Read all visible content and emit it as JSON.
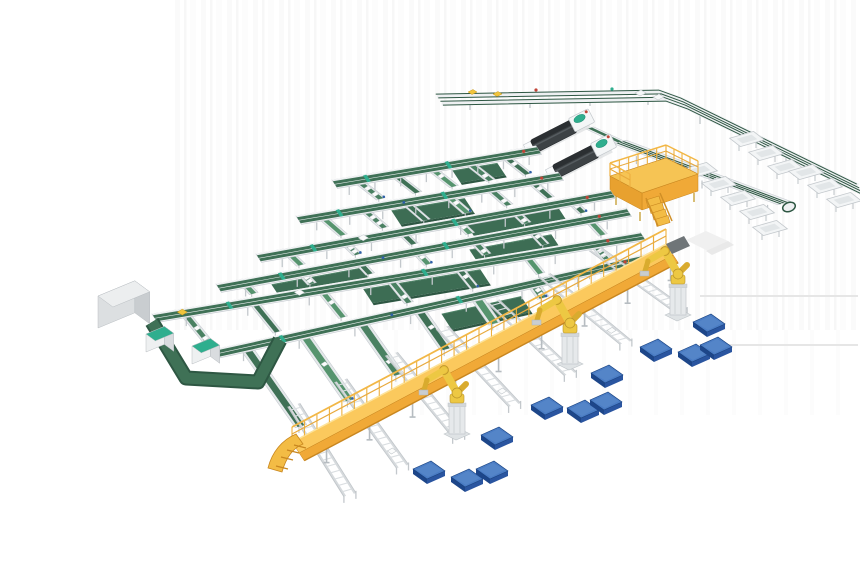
{
  "image": {
    "kind": "3d-isometric-render",
    "alt": "Isometric 3D render of an automated parcel sorting and palletizing system on a white background",
    "background": "white"
  },
  "equipment": {
    "trunk_conveyors": {
      "label": "dual-belt trunk conveyor lines",
      "count": 6
    },
    "sorter_lanes": {
      "label": "inclined green-belt sorter lanes",
      "count": 38
    },
    "wide_belts": {
      "label": "wide green belt conveyors",
      "count": 7
    },
    "u_loop": {
      "label": "U-shaped wide belt loop conveyor",
      "count": 1
    },
    "overhead_rails": {
      "label": "overhead rail conveyors with corner turn",
      "count": 2
    },
    "loop_sorter": {
      "label": "multi-lane loop sorter with U-turn end",
      "count": 1
    },
    "chute_bins": {
      "label": "white chute bins beside loop sorter",
      "count": 11
    },
    "processing_machines": {
      "label": "dark processing machines with teal domes",
      "count": 2
    },
    "operator_platform": {
      "label": "yellow operator platform with guardrail and stairs",
      "count": 1
    },
    "elevated_walkway": {
      "label": "yellow elevated walkway with guardrail and end ramp",
      "count": 1
    },
    "roller_spurs": {
      "label": "white roller conveyor spurs",
      "count": 7
    },
    "robots": {
      "label": "yellow palletizing robot arms on pedestals",
      "count": 3
    },
    "pallets": {
      "label": "blue pallets",
      "count": 12
    },
    "cabinets": {
      "label": "control cabinets (1 gray, 2 teal-top)",
      "count": 3
    },
    "leader_lines": {
      "label": "faint gray annotation leader lines",
      "count": 2
    }
  },
  "colors": {
    "background": "#ffffff",
    "beltGreen": "#3f7156",
    "beltGreenDk": "#2e5743",
    "beltGreenWide": "#3d6d54",
    "laneGreenA": "#4a8162",
    "laneGreenB": "#3f7156",
    "laneGreenC": "#56946e",
    "frameWhite": "#eef0f2",
    "frameEdge": "#c7ccd1",
    "railGray": "#d6dadd",
    "rungGray": "#dadee1",
    "legGray": "#c3c8cc",
    "walkYellow": "#fbc95d",
    "walkFace": "#f0a937",
    "walkDark": "#c8861f",
    "railingYellow": "#edb03e",
    "platYellow": "#f6c454",
    "stepYellow": "#f3bc45",
    "robotYellow": "#edc843",
    "robotJoint": "#d9ab2e",
    "pedestalGray": "#e6e9eb",
    "palletTop": "#4a7cc4",
    "palletFront": "#2a55a0",
    "palletSide": "#1d4689",
    "machineDark": "#3d4245",
    "machineTop": "#2b2f32",
    "teal": "#2fae8e",
    "red": "#c14437",
    "blue": "#2e5fa8",
    "cabTop": "#eceeef",
    "cabFront": "#dcdfe1",
    "cabSide": "#c9cdd0",
    "parcel": "#fbfcfc",
    "leader": "#e6e6e6",
    "ghost": "#f0f0f0",
    "stripeA": "#f6f6f6",
    "stripeB": "#efefef",
    "yellowItem": "#f0c43c"
  }
}
